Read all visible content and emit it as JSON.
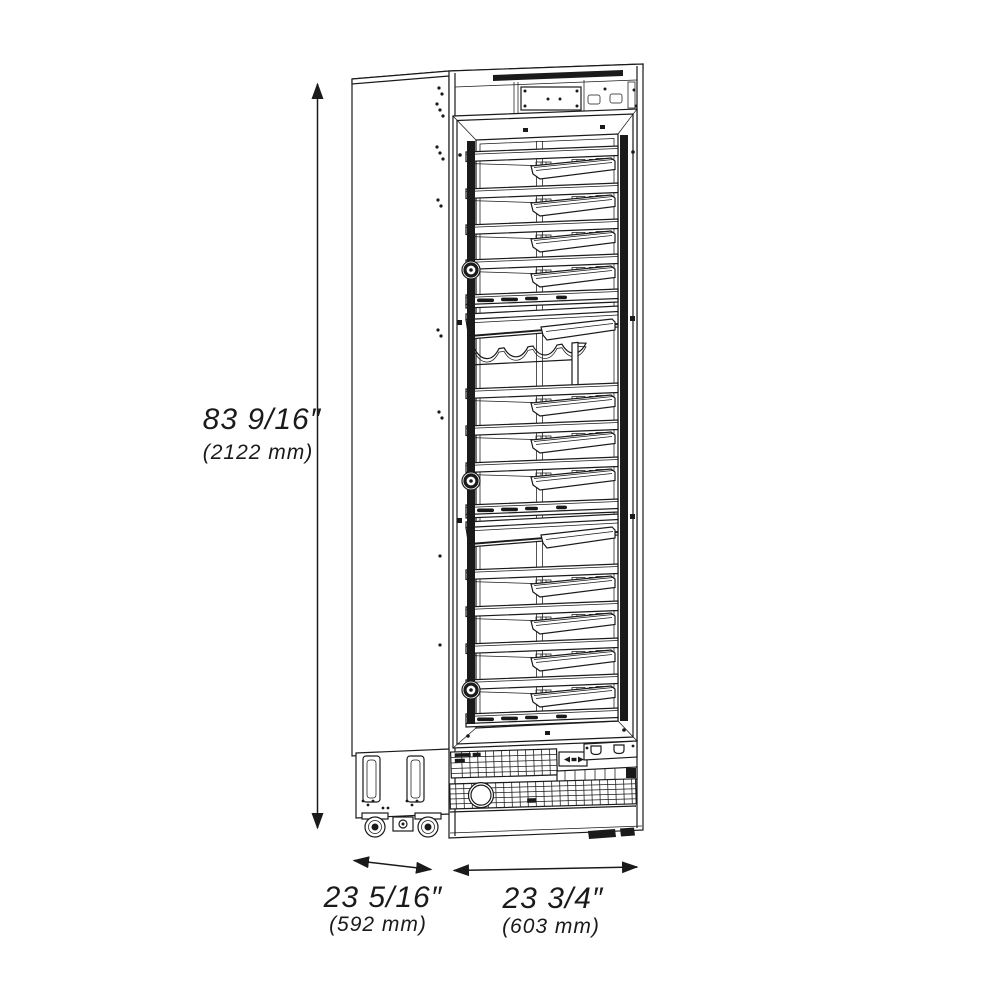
{
  "diagram": {
    "dimensions": {
      "height": {
        "inches": "83 9/16″",
        "metric": "(2122 mm)"
      },
      "depth": {
        "inches": "23 5/16″",
        "metric": "(592 mm)"
      },
      "width": {
        "inches": "23 3/4″",
        "metric": "(603 mm)"
      }
    },
    "colors": {
      "line": "#1a1a1a",
      "background": "#ffffff"
    }
  }
}
